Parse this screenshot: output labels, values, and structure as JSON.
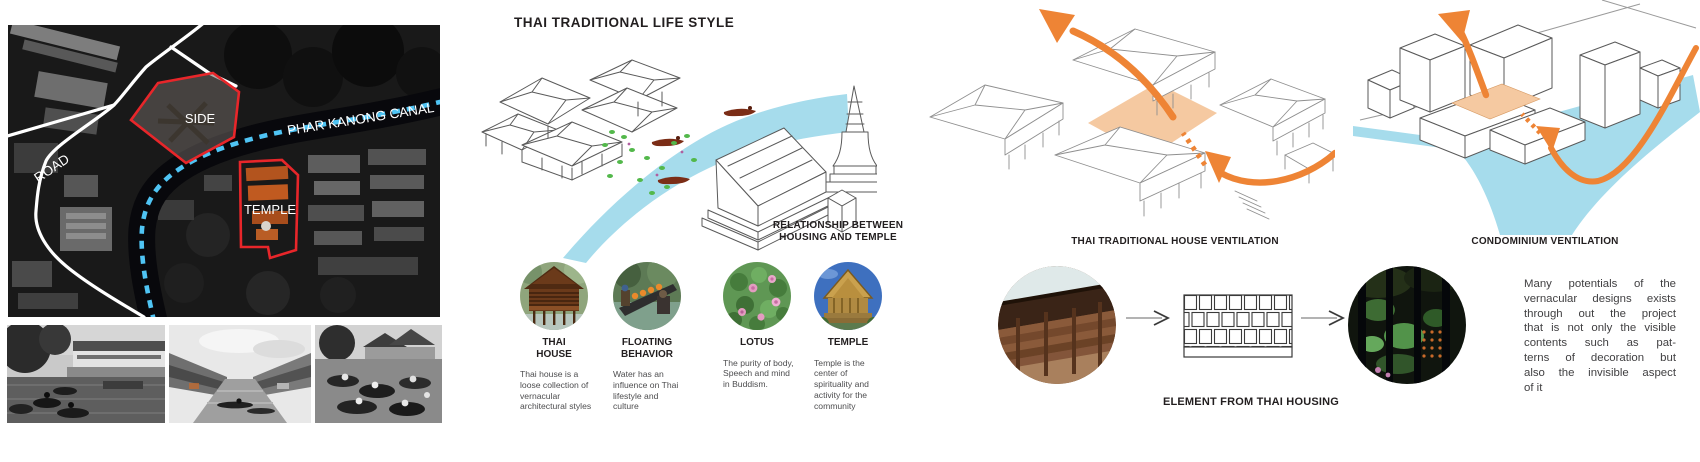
{
  "colors": {
    "accent_orange": "#EE8435",
    "courtyard_fill": "#F5C9A1",
    "water_blue": "#A6DCEC",
    "canal_dash_blue": "#4FC4F4",
    "highlight_red": "#E8262A",
    "heading_text": "#221E1F",
    "body_text": "#4D4D4F"
  },
  "map_panel": {
    "road_label": "ROAD",
    "canal_label": "PHAR KANONG CANAL",
    "site_label": "SIDE",
    "temple_label": "TEMPLE"
  },
  "lifestyle_panel": {
    "title": "THAI TRADITIONAL LIFE STYLE",
    "relationship_caption": [
      "RELATIONSHIP BETWEEN",
      "HOUSING AND TEMPLE"
    ],
    "items": [
      {
        "label": "THAI HOUSE",
        "description": "Thai house is a loose collection of vernacular architectural styles"
      },
      {
        "label": "FLOATING BEHAVIOR",
        "description": "Water has an influence on Thai lifestyle and culture"
      },
      {
        "label": "LOTUS",
        "description": "The purity of body, Speech and mind in Buddism."
      },
      {
        "label": "TEMPLE",
        "description": "Temple is the center of spirituality and activity for the community"
      }
    ]
  },
  "ventilation_panel": {
    "house_caption": "THAI TRADITIONAL HOUSE VENTILATION",
    "condo_caption": "CONDOMINIUM VENTILATION"
  },
  "element_row": {
    "caption": "ELEMENT FROM THAI HOUSING",
    "paragraph_lines": [
      "Many potentials of the",
      "vernacular designs exists",
      "through out the project",
      "that is not only the visible",
      "contents such as pat-",
      "terns of decoration but",
      "also the invisible aspect",
      "of it"
    ]
  }
}
